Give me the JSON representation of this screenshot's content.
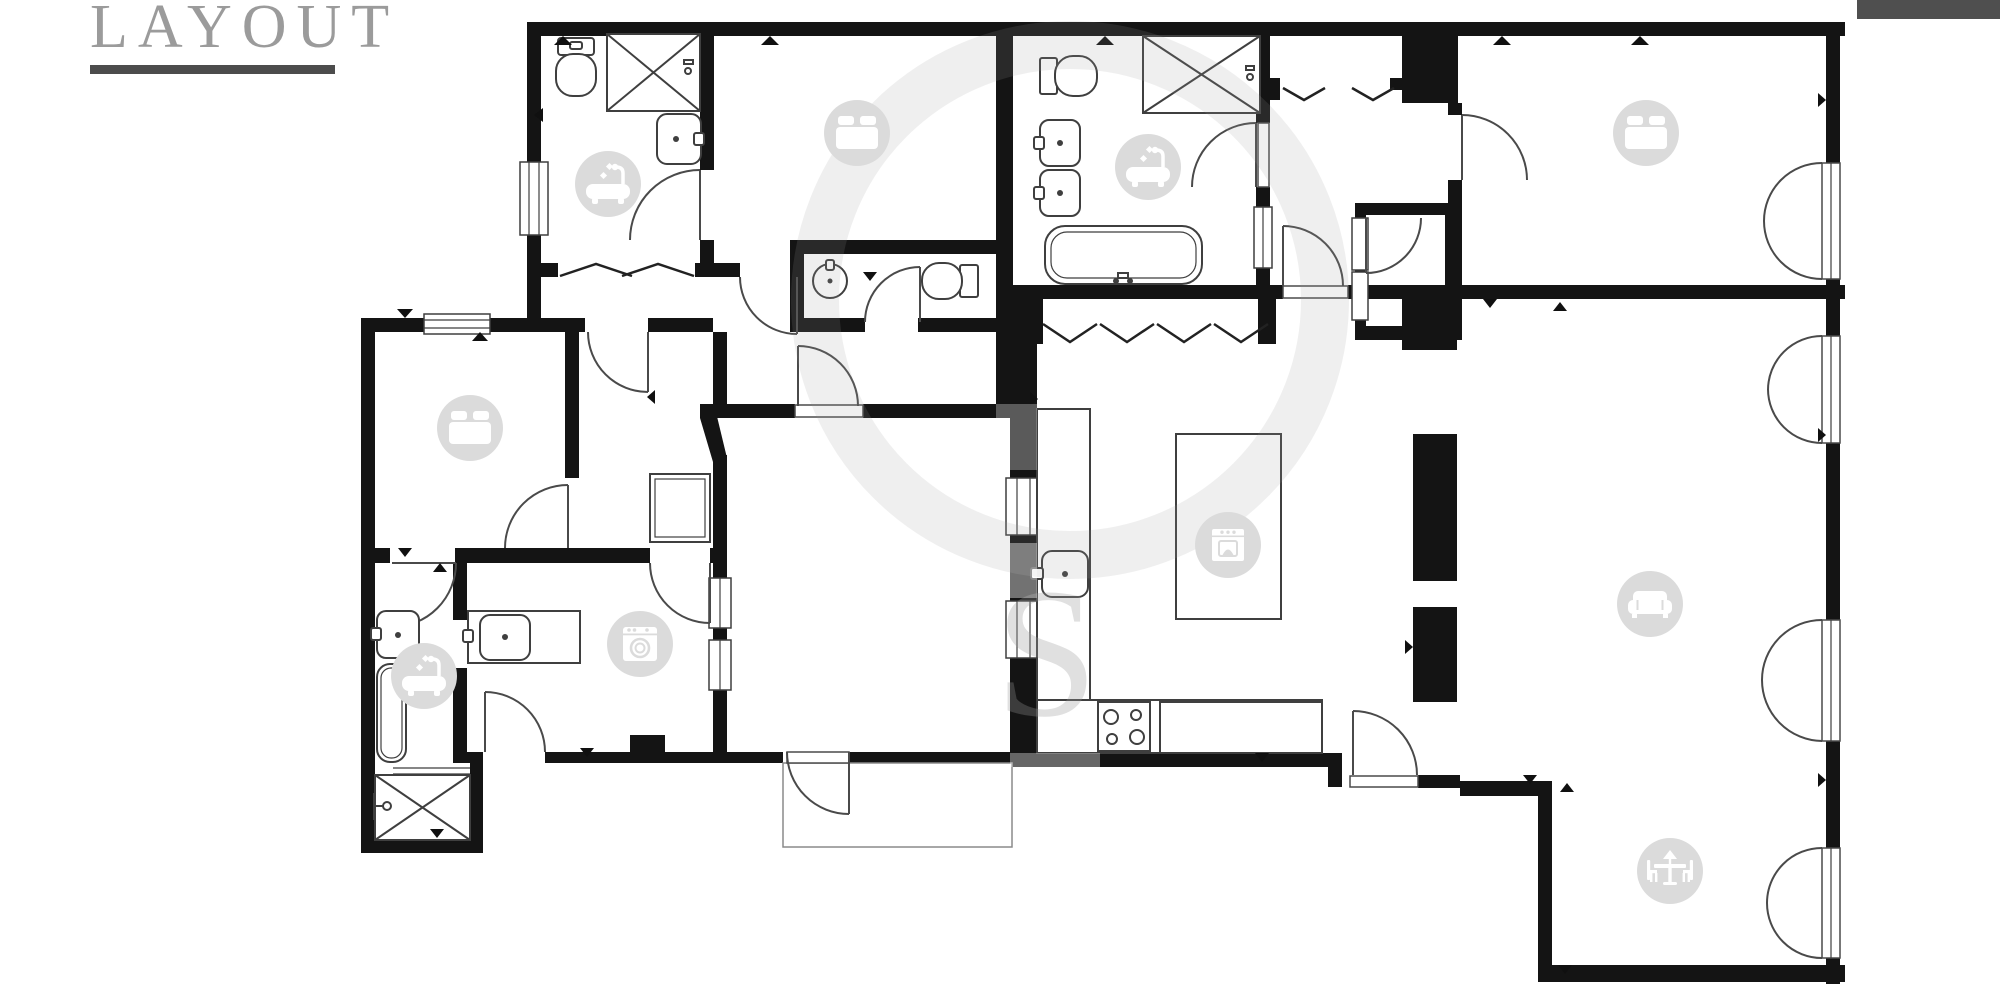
{
  "header": {
    "title": "LAYOUT"
  },
  "colors": {
    "wall": "#141414",
    "fixture": "#3f3f3f",
    "icon_bg": "#dbdbdb",
    "icon_fg": "#ffffff",
    "title": "#9b9b9b",
    "underline": "#4c4c4c",
    "top_right_bar": "#4f4f4f",
    "watermark": "#9a9a9a"
  },
  "floorplan": {
    "rooms": [
      {
        "id": "bathroom-main",
        "icon": "bathtub",
        "x": 608,
        "y": 184
      },
      {
        "id": "bedroom-2",
        "icon": "bed",
        "x": 857,
        "y": 133
      },
      {
        "id": "bathroom-ensuite",
        "icon": "bathtub",
        "x": 1148,
        "y": 167
      },
      {
        "id": "bedroom-1",
        "icon": "bed",
        "x": 1646,
        "y": 133
      },
      {
        "id": "bedroom-3",
        "icon": "bed",
        "x": 470,
        "y": 428
      },
      {
        "id": "bathroom-small",
        "icon": "bathtub",
        "x": 424,
        "y": 676
      },
      {
        "id": "laundry",
        "icon": "washer",
        "x": 640,
        "y": 644
      },
      {
        "id": "kitchen",
        "icon": "stove",
        "x": 1228,
        "y": 545
      },
      {
        "id": "living-room",
        "icon": "sofa",
        "x": 1650,
        "y": 604
      },
      {
        "id": "dining-area",
        "icon": "dining",
        "x": 1670,
        "y": 871
      }
    ]
  }
}
